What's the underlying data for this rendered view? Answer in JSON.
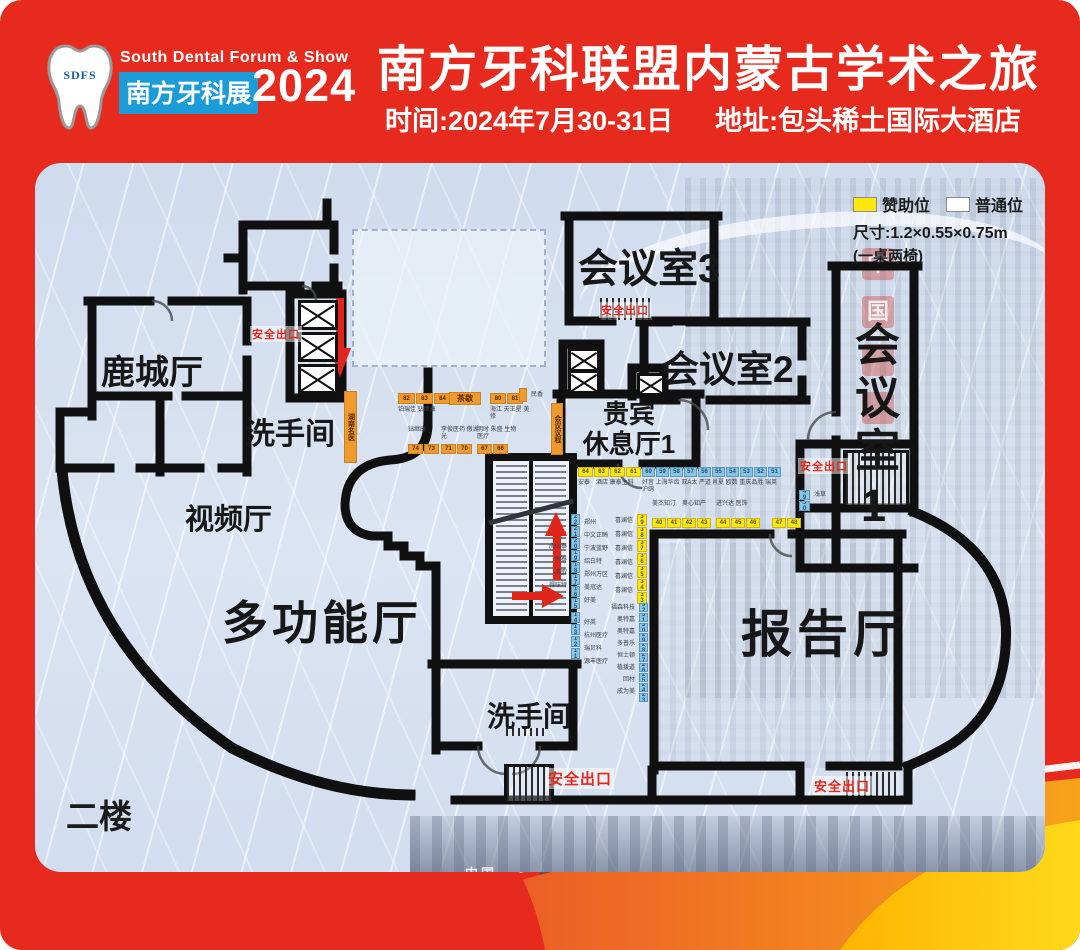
{
  "header": {
    "logo_acronym": "SDFS",
    "logo_en": "South Dental Forum & Show",
    "logo_cn": "南方牙科展",
    "logo_year": "2024",
    "title": "南方牙科联盟内蒙古学术之旅",
    "time_label": "时间:2024年7月30-31日",
    "address_label": "地址:包头稀土国际大酒店"
  },
  "legend": {
    "sponsor": "赞助位",
    "regular": "普通位",
    "size": "尺寸:1.2×0.55×0.75m",
    "note": "(一桌两椅)"
  },
  "floor_label": "二楼",
  "rooms": {
    "meeting3": "会议室3",
    "meeting2": "会议室2",
    "meeting1": "会议室1",
    "lucheng": "鹿城厅",
    "restroom_top": "洗手间",
    "video": "视频厅",
    "multifunction": "多功能厅",
    "vip_line1": "贵宾",
    "vip_line2": "休息厅1",
    "lecture": "报告厅",
    "restroom_bottom": "洗手间"
  },
  "markers": {
    "exit_label": "安全出口"
  },
  "background": {
    "sign_char1": "中",
    "sign_char2": "国",
    "photo_text": "中国──"
  },
  "booth_groups": [
    {
      "id": "a1",
      "color": "orange",
      "cells": [
        "82",
        "83",
        "84"
      ],
      "label": "铂瑞佳 钻继康",
      "label_pos": "below"
    },
    {
      "id": "tea",
      "color": "orange",
      "cells": [
        "茶歇"
      ]
    },
    {
      "id": "a2",
      "color": "orange",
      "cells": [
        "80",
        "81"
      ],
      "label": "海江 天王星 美修",
      "label_pos": "below"
    },
    {
      "id": "a3",
      "color": "orange",
      "vertical": true,
      "cells": [
        ""
      ],
      "labels_right": [
        "民香"
      ]
    },
    {
      "id": "agenda",
      "color": "orange",
      "vertical": true,
      "cells": [
        "会议议程"
      ]
    },
    {
      "id": "side",
      "color": "orange",
      "vertical": true,
      "cells": [
        "湖南名医"
      ]
    },
    {
      "id": "b1",
      "color": "orange",
      "cells": [
        "74",
        "73"
      ],
      "label": "钻继康",
      "label_pos": "above"
    },
    {
      "id": "b2",
      "color": "orange",
      "cells": [
        "71",
        "70"
      ],
      "label": "李俊医药 傲湖光",
      "label_pos": "above"
    },
    {
      "id": "b3",
      "color": "orange",
      "cells": [
        "67",
        "66"
      ],
      "label": "明时 朱盛 生物医疗",
      "label_pos": "above"
    },
    {
      "id": "c1",
      "color": "yellow",
      "cells": [
        "64",
        "63",
        "62",
        "61"
      ],
      "label": "安泰　酒店 康泰主科",
      "label_pos": "below"
    },
    {
      "id": "c2",
      "color": "blue",
      "cells": [
        "60",
        "59",
        "58",
        "57",
        "56"
      ],
      "label": "好音 上海华齿 双A太 严道 沪鸽",
      "label_pos": "below"
    },
    {
      "id": "c3",
      "color": "blue",
      "cells": [
        "55",
        "54",
        "53",
        "52",
        "51"
      ],
      "label": "肖夏 欧数 重庆品胜 瑞英",
      "label_pos": "below"
    },
    {
      "id": "d1",
      "color": "yellow",
      "cells": [
        "40",
        "41",
        "42",
        "43"
      ],
      "label": "美杰知汀　奥心知产",
      "label_pos": "above"
    },
    {
      "id": "d2",
      "color": "yellow",
      "cells": [
        "44",
        "45",
        "46"
      ],
      "label": "进兴达 医饰",
      "label_pos": "above"
    },
    {
      "id": "d3",
      "color": "yellow",
      "cells": [
        "47",
        "48"
      ]
    },
    {
      "id": "d4",
      "color": "blue",
      "vertical": true,
      "cells": [
        "49",
        "50"
      ],
      "labels_right": [
        "浅草"
      ]
    },
    {
      "id": "e1",
      "color": "blue",
      "vertical": true,
      "cells": [
        "22",
        "21",
        "20",
        "19",
        "18",
        "17",
        "16",
        "15"
      ],
      "labels_right": [
        "郑州",
        "中文正畸",
        "宁波蓝野",
        "绍白特",
        "郑州万区",
        "美冠达",
        "好美"
      ],
      "labels_left": [
        "虎山泰",
        "恒泰",
        "成取",
        "得味特"
      ]
    },
    {
      "id": "e2",
      "color": "blue",
      "vertical": true,
      "cells": [
        "14",
        "13",
        "12",
        "11"
      ],
      "labels_right": [
        "好英",
        "杭州医疗",
        "瑞贝科",
        "源丰医疗"
      ]
    },
    {
      "id": "f1",
      "color": "yellow",
      "vertical": true,
      "cells": [
        "39",
        "38",
        "37",
        "36",
        "35",
        "34",
        "33"
      ],
      "labels_left": [
        "喜澜信",
        "喜澜信",
        "喜澜信",
        "喜澜信",
        "喜澜信",
        "喜澜信"
      ]
    },
    {
      "id": "g1",
      "color": "blue",
      "vertical": true,
      "cells": [
        "32",
        "31",
        "30",
        "29",
        "28",
        "27",
        "26",
        "25",
        "24",
        "23"
      ],
      "labels_left": [
        "福森科技",
        "奥特嘉",
        "奥特嘉",
        "多普乐",
        "恒士顿",
        "植援道",
        "回材",
        "成为美"
      ]
    }
  ]
}
